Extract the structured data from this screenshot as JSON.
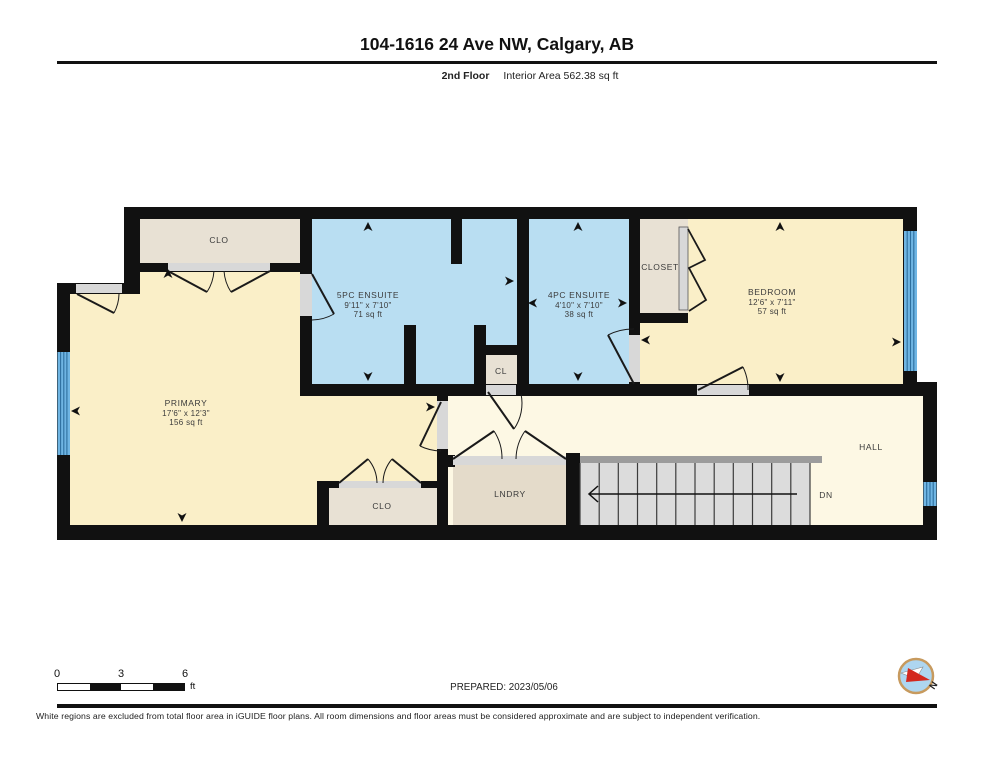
{
  "header": {
    "title": "104-1616 24 Ave NW, Calgary, AB",
    "floor_label": "2nd Floor",
    "area_label": "Interior Area 562.38 sq ft"
  },
  "rooms": {
    "clo_upper": {
      "name": "CLO"
    },
    "primary": {
      "name": "PRIMARY",
      "dims": "17'6\" x 12'3\"",
      "area": "156 sq ft"
    },
    "ensuite_5pc": {
      "name": "5PC ENSUITE",
      "dims": "9'11\" x 7'10\"",
      "area": "71 sq ft"
    },
    "cl": {
      "name": "CL"
    },
    "ensuite_4pc": {
      "name": "4PC ENSUITE",
      "dims": "4'10\" x 7'10\"",
      "area": "38 sq ft"
    },
    "closet": {
      "name": "CLOSET"
    },
    "bedroom": {
      "name": "BEDROOM",
      "dims": "12'6\" x 7'11\"",
      "area": "57 sq ft"
    },
    "hall": {
      "name": "HALL"
    },
    "lndry": {
      "name": "LNDRY"
    },
    "clo_lower": {
      "name": "CLO"
    },
    "stairs": {
      "direction_label": "DN"
    }
  },
  "scale_bar": {
    "ticks": [
      "0",
      "3",
      "6"
    ],
    "unit": "ft"
  },
  "compass": {
    "north_label": "N"
  },
  "footer": {
    "prepared": "PREPARED: 2023/05/06",
    "disclaimer": "White regions are excluded from total floor area in iGUIDE floor plans. All room dimensions and floor areas must be considered approximate and are subject to independent verification."
  },
  "colors": {
    "room_yellow": "#FAEFC8",
    "hall_yellow": "#FDF8E4",
    "bath_blue": "#B9DEF2",
    "closet_beige": "#E8E1D4",
    "lndry_beige": "#E4DBCA",
    "wall_black": "#111111",
    "stair_gray": "#DCDCDC",
    "window_blue": "#6FB5E3",
    "compass_red": "#D3281E"
  }
}
